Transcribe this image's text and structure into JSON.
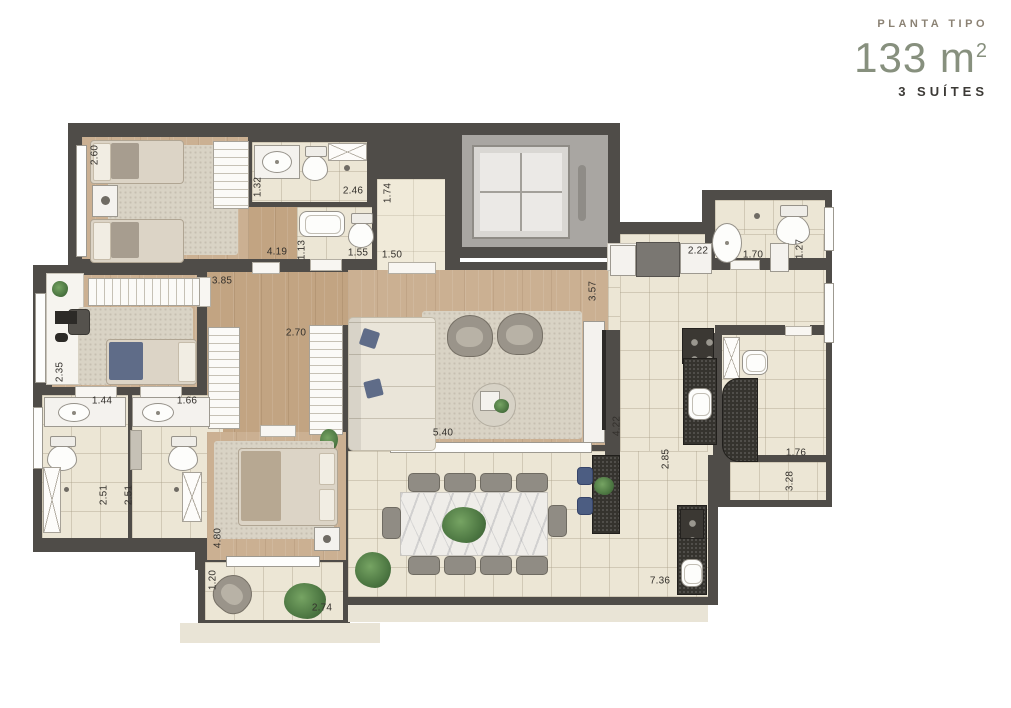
{
  "header": {
    "kicker": "PLANTA TIPO",
    "area_value": "133 m",
    "area_superscript": "2",
    "suites_label": "3 SUÍTES"
  },
  "palette": {
    "accent_sage": "#87907e",
    "wall_dark": "#4f4c48",
    "wood_floor": "#cbb092",
    "tile_floor": "#ece6d5",
    "counter_dark": "#35332e",
    "label_text": "#33302c"
  },
  "plan": {
    "dimensions": [
      {
        "text": "2.60",
        "orientation": "v"
      },
      {
        "text": "1.32",
        "orientation": "v"
      },
      {
        "text": "2.46",
        "orientation": "h"
      },
      {
        "text": "1.74",
        "orientation": "v"
      },
      {
        "text": "1.13",
        "orientation": "v"
      },
      {
        "text": "1.55",
        "orientation": "h"
      },
      {
        "text": "1.50",
        "orientation": "h"
      },
      {
        "text": "4.19",
        "orientation": "h"
      },
      {
        "text": "3.85",
        "orientation": "h"
      },
      {
        "text": "2.22",
        "orientation": "h"
      },
      {
        "text": "1.70",
        "orientation": "h"
      },
      {
        "text": "1.27",
        "orientation": "v"
      },
      {
        "text": "3.57",
        "orientation": "v"
      },
      {
        "text": "2.35",
        "orientation": "v"
      },
      {
        "text": "1.44",
        "orientation": "h"
      },
      {
        "text": "1.66",
        "orientation": "h"
      },
      {
        "text": "2.70",
        "orientation": "h"
      },
      {
        "text": "5.40",
        "orientation": "h"
      },
      {
        "text": "4.22",
        "orientation": "v"
      },
      {
        "text": "2.85",
        "orientation": "v"
      },
      {
        "text": "1.76",
        "orientation": "h"
      },
      {
        "text": "3.28",
        "orientation": "v"
      },
      {
        "text": "2.51",
        "orientation": "v"
      },
      {
        "text": "2.51",
        "orientation": "v"
      },
      {
        "text": "4.80",
        "orientation": "v"
      },
      {
        "text": "1.20",
        "orientation": "v"
      },
      {
        "text": "2.74",
        "orientation": "h"
      },
      {
        "text": "7.36",
        "orientation": "h"
      }
    ]
  }
}
